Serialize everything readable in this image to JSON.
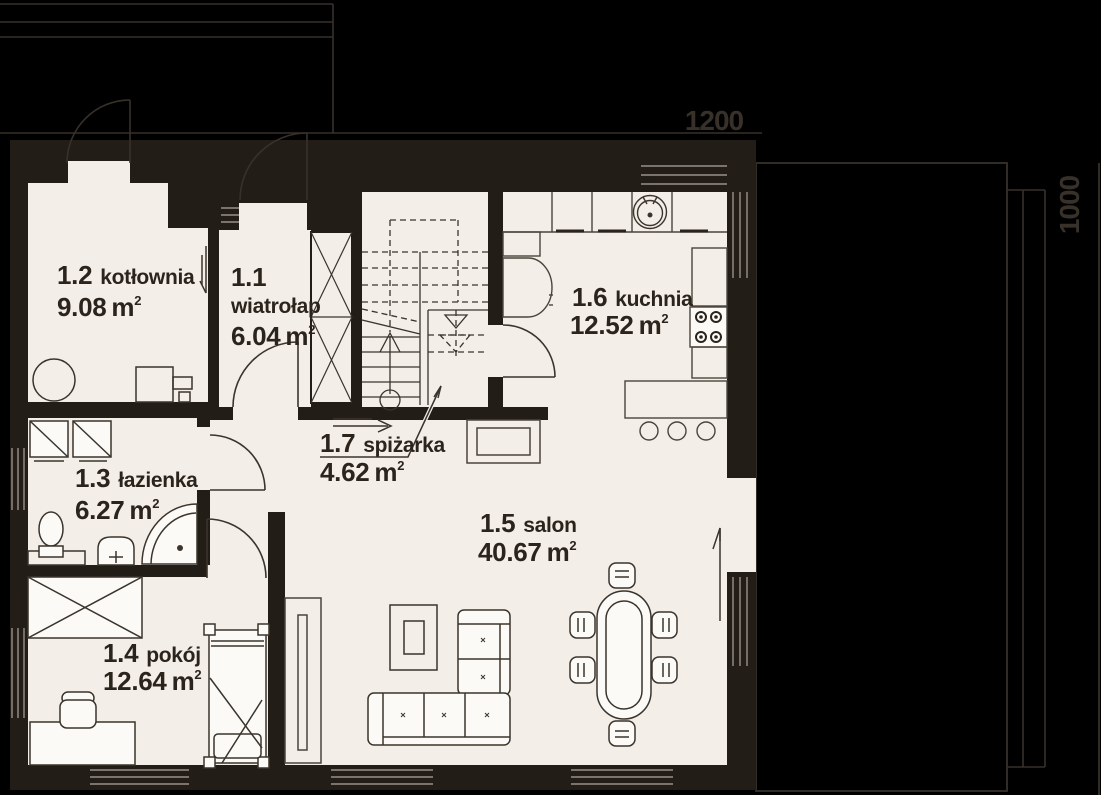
{
  "plan": {
    "dimension_top": "1200",
    "dimension_right": "1000",
    "area_unit": "m",
    "area_exponent": "2",
    "rooms": [
      {
        "number": "1.1",
        "name": "wiatrołap",
        "area": "6.04"
      },
      {
        "number": "1.2",
        "name": "kotłownia",
        "area": "9.08"
      },
      {
        "number": "1.3",
        "name": "łazienka",
        "area": "6.27"
      },
      {
        "number": "1.4",
        "name": "pokój",
        "area": "12.64"
      },
      {
        "number": "1.5",
        "name": "salon",
        "area": "40.67"
      },
      {
        "number": "1.6",
        "name": "kuchnia",
        "area": "12.52"
      },
      {
        "number": "1.7",
        "name": "spiżarka",
        "area": "4.62"
      }
    ]
  }
}
